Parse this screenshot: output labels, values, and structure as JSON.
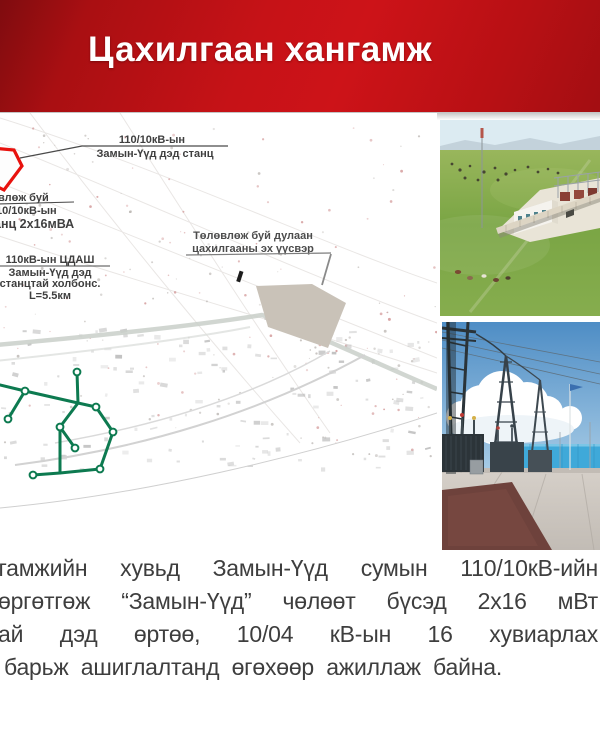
{
  "header": {
    "title": "Цахилгаан хангамж"
  },
  "map": {
    "annotations": {
      "existing_substation": {
        "line1": "110/10кВ-ын",
        "line2": "Замын-Үүд дэд станц"
      },
      "planned_substation": {
        "line1": "влөж буй",
        "line2": "10/10кВ-ын",
        "line3": "анц 2х16мВА"
      },
      "thermal_source": {
        "line1": "Төлөвлөж буй дулаан",
        "line2": "цахилгааны эх үүсвэр"
      },
      "power_line": {
        "line1": "110кВ-ын ЦДАШ",
        "line2": "Замын-Үүд дэд",
        "line3": "станцтай холбонс.",
        "line4": "L=5.5км"
      }
    }
  },
  "paragraph": {
    "lines": [
      "нгамжийн хувьд Замын-Үүд сумын 110/10кВ-ийн",
      "өргөтгөж “Замын-Үүд” чөлөөт бүсэд 2х16 мВт",
      "ай дэд өртөө, 10/04 кВ-ын 16 хувиарлах",
      "барьж ашиглалтанд өгөхөөр ажиллаж байна."
    ]
  },
  "colors": {
    "header_red": "#c61217",
    "header_dark_red": "#7f0c0f",
    "network_green": "#0d7a50",
    "highlight_red": "#e8120e",
    "body_text": "#3e3e3e"
  }
}
